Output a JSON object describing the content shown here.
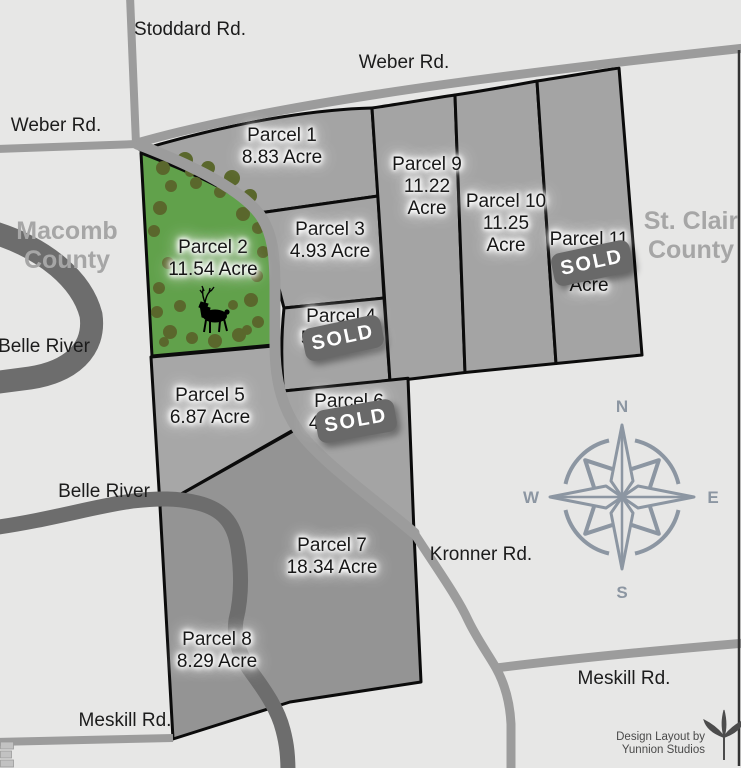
{
  "title": "Land parcel sales map",
  "counties": {
    "macomb": {
      "line1": "Macomb",
      "line2": "County"
    },
    "st_clair": {
      "line1": "St. Clair",
      "line2": "County"
    }
  },
  "roads": {
    "stoddard": "Stoddard Rd.",
    "weber_left": "Weber Rd.",
    "weber_top": "Weber Rd.",
    "kronner": "Kronner Rd.",
    "meskill_left": "Meskill Rd.",
    "meskill_right": "Meskill Rd."
  },
  "river": {
    "label_upper": "Belle River",
    "label_lower": "Belle River"
  },
  "parcels": {
    "p1": {
      "name": "Parcel 1",
      "acreage": "8.83 Acre",
      "sold": false
    },
    "p2": {
      "name": "Parcel 2",
      "acreage": "11.54 Acre",
      "sold": false,
      "wooded": true
    },
    "p3": {
      "name": "Parcel 3",
      "acreage": "4.93 Acre",
      "sold": false
    },
    "p4": {
      "name": "Parcel 4",
      "acreage": "5.36 Acre",
      "sold": true
    },
    "p5": {
      "name": "Parcel 5",
      "acreage": "6.87 Acre",
      "sold": false
    },
    "p6": {
      "name": "Parcel 6",
      "acreage": "4.51 Acre",
      "sold": true
    },
    "p7": {
      "name": "Parcel 7",
      "acreage": "18.34 Acre",
      "sold": false
    },
    "p8": {
      "name": "Parcel 8",
      "acreage": "8.29 Acre",
      "sold": false
    },
    "p9": {
      "name": "Parcel 9",
      "acreage_value": "11.22",
      "acreage_unit": "Acre",
      "sold": false
    },
    "p10": {
      "name": "Parcel 10",
      "acreage_value": "11.25",
      "acreage_unit": "Acre",
      "sold": false
    },
    "p11": {
      "name": "Parcel 11",
      "acreage_unit": "Acre",
      "sold": true
    }
  },
  "sold_badge": "SOLD",
  "compass": {
    "n": "N",
    "e": "E",
    "s": "S",
    "w": "W"
  },
  "credit": {
    "line1": "Design Layout by",
    "line2": "Yunnion Studios"
  },
  "icons": {
    "deer": "deer-silhouette",
    "compass": "compass-rose",
    "logo": "yunnion-studios-logo",
    "trees": "tree-canopy"
  },
  "colors": {
    "background": "#e7e7e6",
    "parcel_gray": "#a4a4a4",
    "parcel_dark_gray": "#949494",
    "wooded_green": "#61a14b",
    "tree_green": "#5a672c",
    "river_gray": "#6d6d6d",
    "road_gray": "#9c9c9c",
    "boundary_black": "#0b0b0b",
    "sold_badge_gray": "#696969",
    "compass_slate": "#8c96a2",
    "county_label_gray": "#a6a6a6"
  }
}
